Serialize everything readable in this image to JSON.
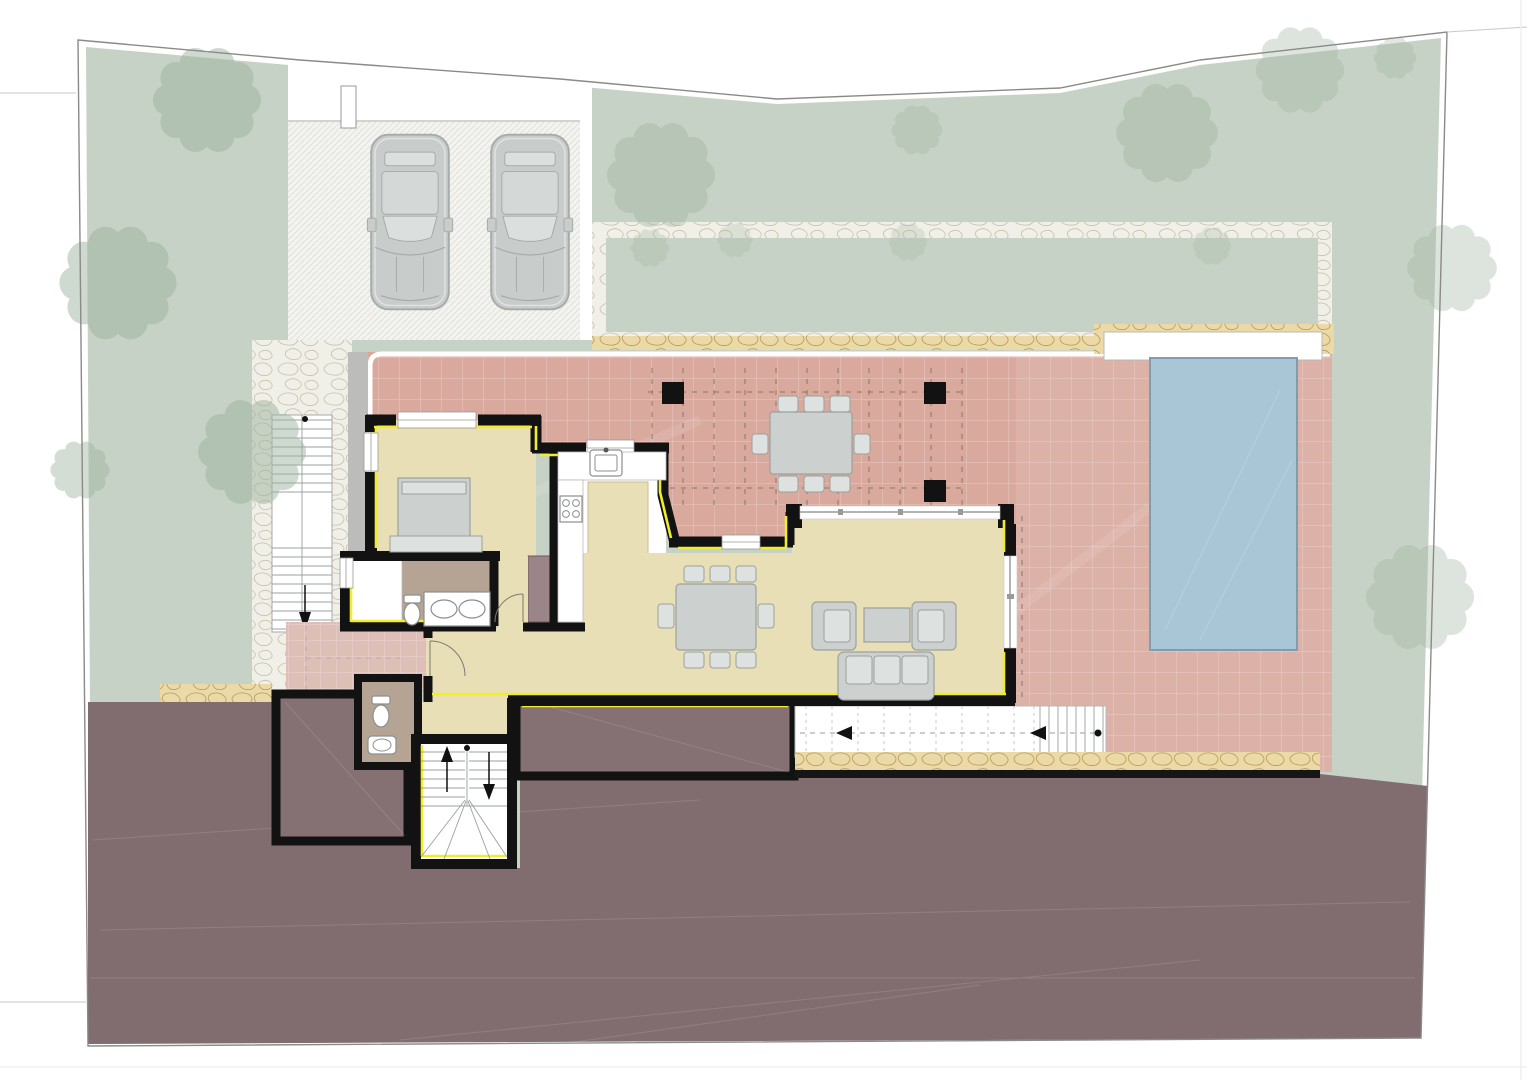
{
  "palette": {
    "paper": "#ffffff",
    "boundary": "#8a8a88",
    "lawn": "#c7d2c6",
    "tree": "#9fb4a0",
    "stonePathBg": "#f0efe8",
    "tanBand": "#ecd9a8",
    "driveway": "#f3f3f0",
    "terrace": "#d9a99e",
    "entryPaving": "#ddbfb7",
    "roomCream": "#e9dfb6",
    "kitchenWhite": "#ffffff",
    "bathFloor": "#b5a493",
    "wardrobe": "#9b8588",
    "terrain": "#816d6f",
    "lowerBlock": "#857173",
    "pool": "#a9c6d7",
    "poolEdge": "#7f9dae",
    "wall": "#121212",
    "yellow": "#f0ec30",
    "furnFill": "#ccd0ce",
    "furnStroke": "#9ba19e",
    "furnLight": "#dde1df",
    "fixtureWhite": "#ffffff",
    "fixtureStroke": "#8a8f8c",
    "glassLine": "#9a9a98",
    "dashBrown": "#8b6f63",
    "carBody": "#c8cccb",
    "carLine": "#a6aaa8",
    "carGlass": "#dbe0df",
    "carRoof": "#d4d8d6"
  },
  "inventory": {
    "cars": 2,
    "pools": 1,
    "pergola_posts": 3,
    "indoor_dining_chairs": 8,
    "outdoor_dining_chairs": 8,
    "armchairs": 2,
    "sofas": 1,
    "beds": 1,
    "toilets": 2,
    "bathroom_basins": 2,
    "staircases": 4,
    "trees_large": 10
  }
}
